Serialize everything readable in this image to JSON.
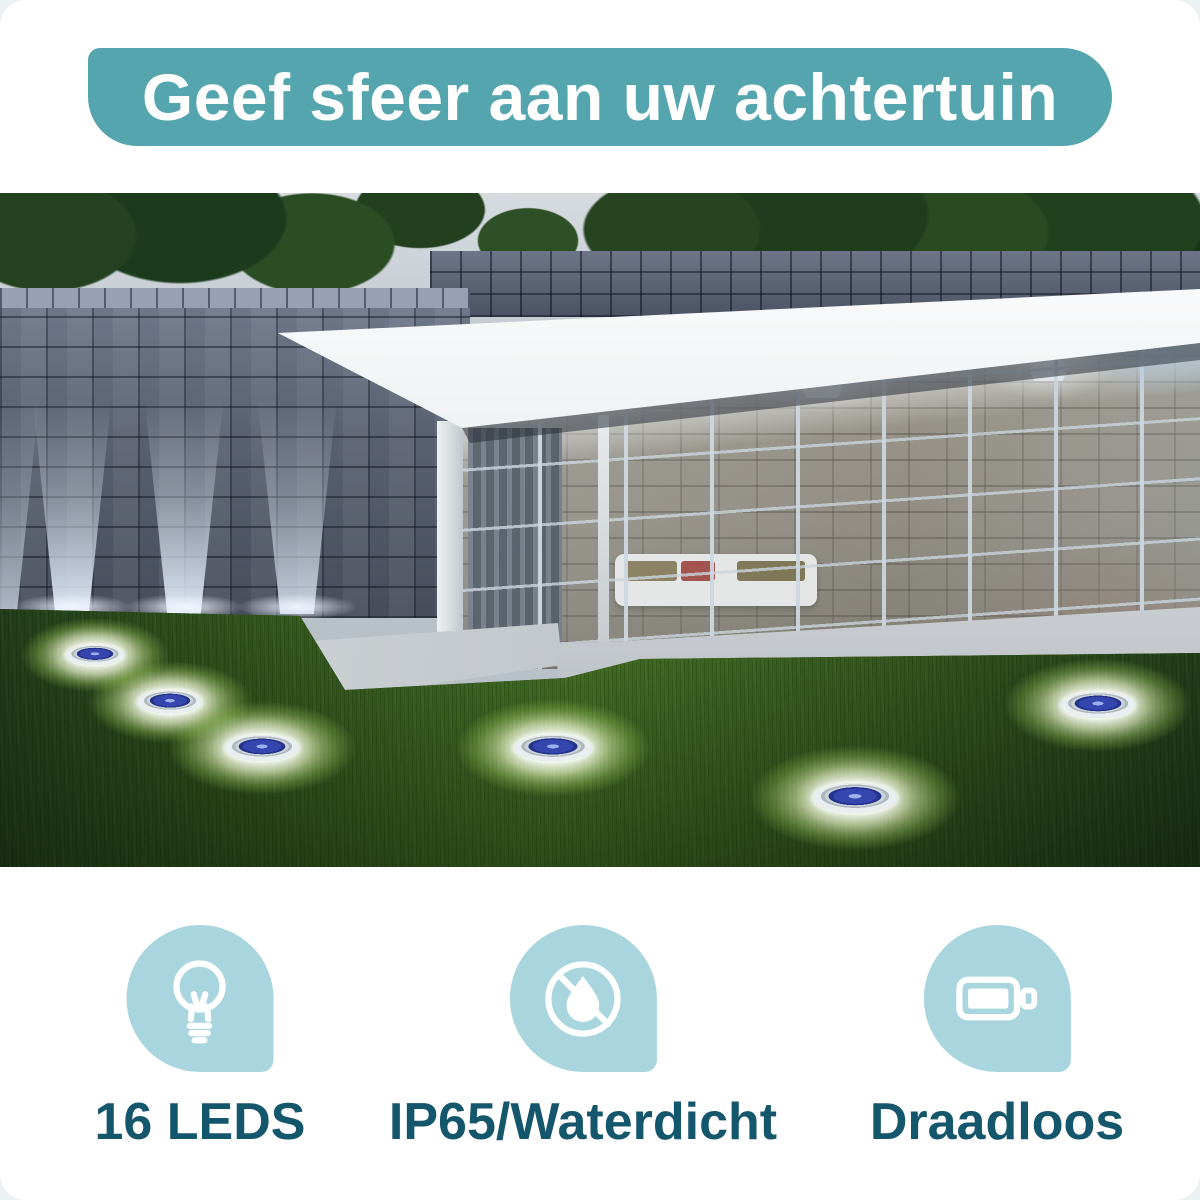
{
  "banner": {
    "text": "Geef sfeer aan uw achtertuin"
  },
  "features": [
    {
      "icon": "light-bulb-icon",
      "label": "16 LEDS"
    },
    {
      "icon": "no-water-icon",
      "label": "IP65/Waterdicht"
    },
    {
      "icon": "battery-icon",
      "label": "Draadloos"
    }
  ],
  "scene": {
    "description": "Backyard at dusk: grey stone garden wall with uplights, modern glass garden room with white flat roof, three ceiling lamps and a white sofa, green lawn with six glowing solar ground lights",
    "ground_light_count": 6
  },
  "colors": {
    "page_background": "#ECF1F3",
    "card_background": "#FFFFFF",
    "banner_teal": "#55A5AF",
    "icon_bubble_blue": "#A9D6DE",
    "label_teal": "#14566B",
    "icon_glyph_white": "#FFFFFF"
  }
}
